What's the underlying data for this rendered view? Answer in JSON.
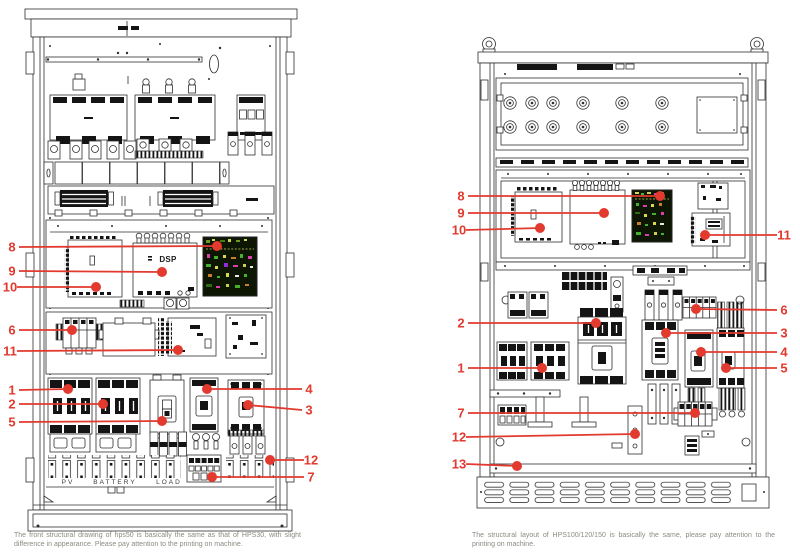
{
  "colors": {
    "callout": "#e23a2e",
    "line": "#2f2f2f",
    "black_fill": "#141414",
    "caption_text": "#8b8b82",
    "pcb_board": "#0d1503"
  },
  "left_diagram": {
    "caption": "The front structural drawing of hps50 is basically the same as that of HPS30, with slight difference in appearance. Please pay attention to the printing on machine.",
    "labels": {
      "dsp": "DSP",
      "pv": "PV",
      "battery": "BATTERY",
      "load": "LOAD"
    },
    "callouts": [
      {
        "n": "8",
        "side": "left",
        "lx": 12,
        "ly": 247,
        "dx": 217,
        "dy": 246
      },
      {
        "n": "9",
        "side": "left",
        "lx": 12,
        "ly": 271,
        "dx": 162,
        "dy": 272
      },
      {
        "n": "10",
        "side": "left",
        "lx": 10,
        "ly": 287,
        "dx": 96,
        "dy": 287
      },
      {
        "n": "6",
        "side": "left",
        "lx": 12,
        "ly": 330,
        "dx": 72,
        "dy": 330
      },
      {
        "n": "11",
        "side": "left",
        "lx": 10,
        "ly": 351,
        "dx": 178,
        "dy": 350
      },
      {
        "n": "1",
        "side": "left",
        "lx": 12,
        "ly": 390,
        "dx": 68,
        "dy": 389
      },
      {
        "n": "2",
        "side": "left",
        "lx": 12,
        "ly": 404,
        "dx": 103,
        "dy": 404
      },
      {
        "n": "5",
        "side": "left",
        "lx": 12,
        "ly": 422,
        "dx": 162,
        "dy": 421
      },
      {
        "n": "4",
        "side": "right",
        "lx": 309,
        "ly": 389,
        "dx": 207,
        "dy": 389
      },
      {
        "n": "3",
        "side": "right",
        "lx": 309,
        "ly": 410,
        "dx": 248,
        "dy": 405
      },
      {
        "n": "12",
        "side": "right",
        "lx": 311,
        "ly": 460,
        "dx": 270,
        "dy": 460
      },
      {
        "n": "7",
        "side": "right",
        "lx": 311,
        "ly": 477,
        "dx": 212,
        "dy": 477
      }
    ]
  },
  "right_diagram": {
    "caption": "The structural layout of HPS100/120/150 is basically the same, please pay attention to the printing on machine.",
    "callouts": [
      {
        "n": "8",
        "side": "left",
        "lx": 461,
        "ly": 196,
        "dx": 660,
        "dy": 196
      },
      {
        "n": "9",
        "side": "left",
        "lx": 461,
        "ly": 213,
        "dx": 604,
        "dy": 213
      },
      {
        "n": "10",
        "side": "left",
        "lx": 459,
        "ly": 230,
        "dx": 540,
        "dy": 228
      },
      {
        "n": "11",
        "side": "right",
        "lx": 784,
        "ly": 235,
        "dx": 705,
        "dy": 235
      },
      {
        "n": "6",
        "side": "right",
        "lx": 784,
        "ly": 310,
        "dx": 696,
        "dy": 309
      },
      {
        "n": "2",
        "side": "left",
        "lx": 461,
        "ly": 323,
        "dx": 596,
        "dy": 323
      },
      {
        "n": "3",
        "side": "right",
        "lx": 784,
        "ly": 333,
        "dx": 666,
        "dy": 333
      },
      {
        "n": "1",
        "side": "left",
        "lx": 461,
        "ly": 368,
        "dx": 542,
        "dy": 368
      },
      {
        "n": "4",
        "side": "right",
        "lx": 784,
        "ly": 352,
        "dx": 701,
        "dy": 352
      },
      {
        "n": "5",
        "side": "right",
        "lx": 784,
        "ly": 368,
        "dx": 726,
        "dy": 368
      },
      {
        "n": "7",
        "side": "left",
        "lx": 461,
        "ly": 413,
        "dx": 695,
        "dy": 413
      },
      {
        "n": "12",
        "side": "left",
        "lx": 459,
        "ly": 437,
        "dx": 635,
        "dy": 434
      },
      {
        "n": "13",
        "side": "left",
        "lx": 459,
        "ly": 464,
        "dx": 517,
        "dy": 466
      }
    ]
  }
}
